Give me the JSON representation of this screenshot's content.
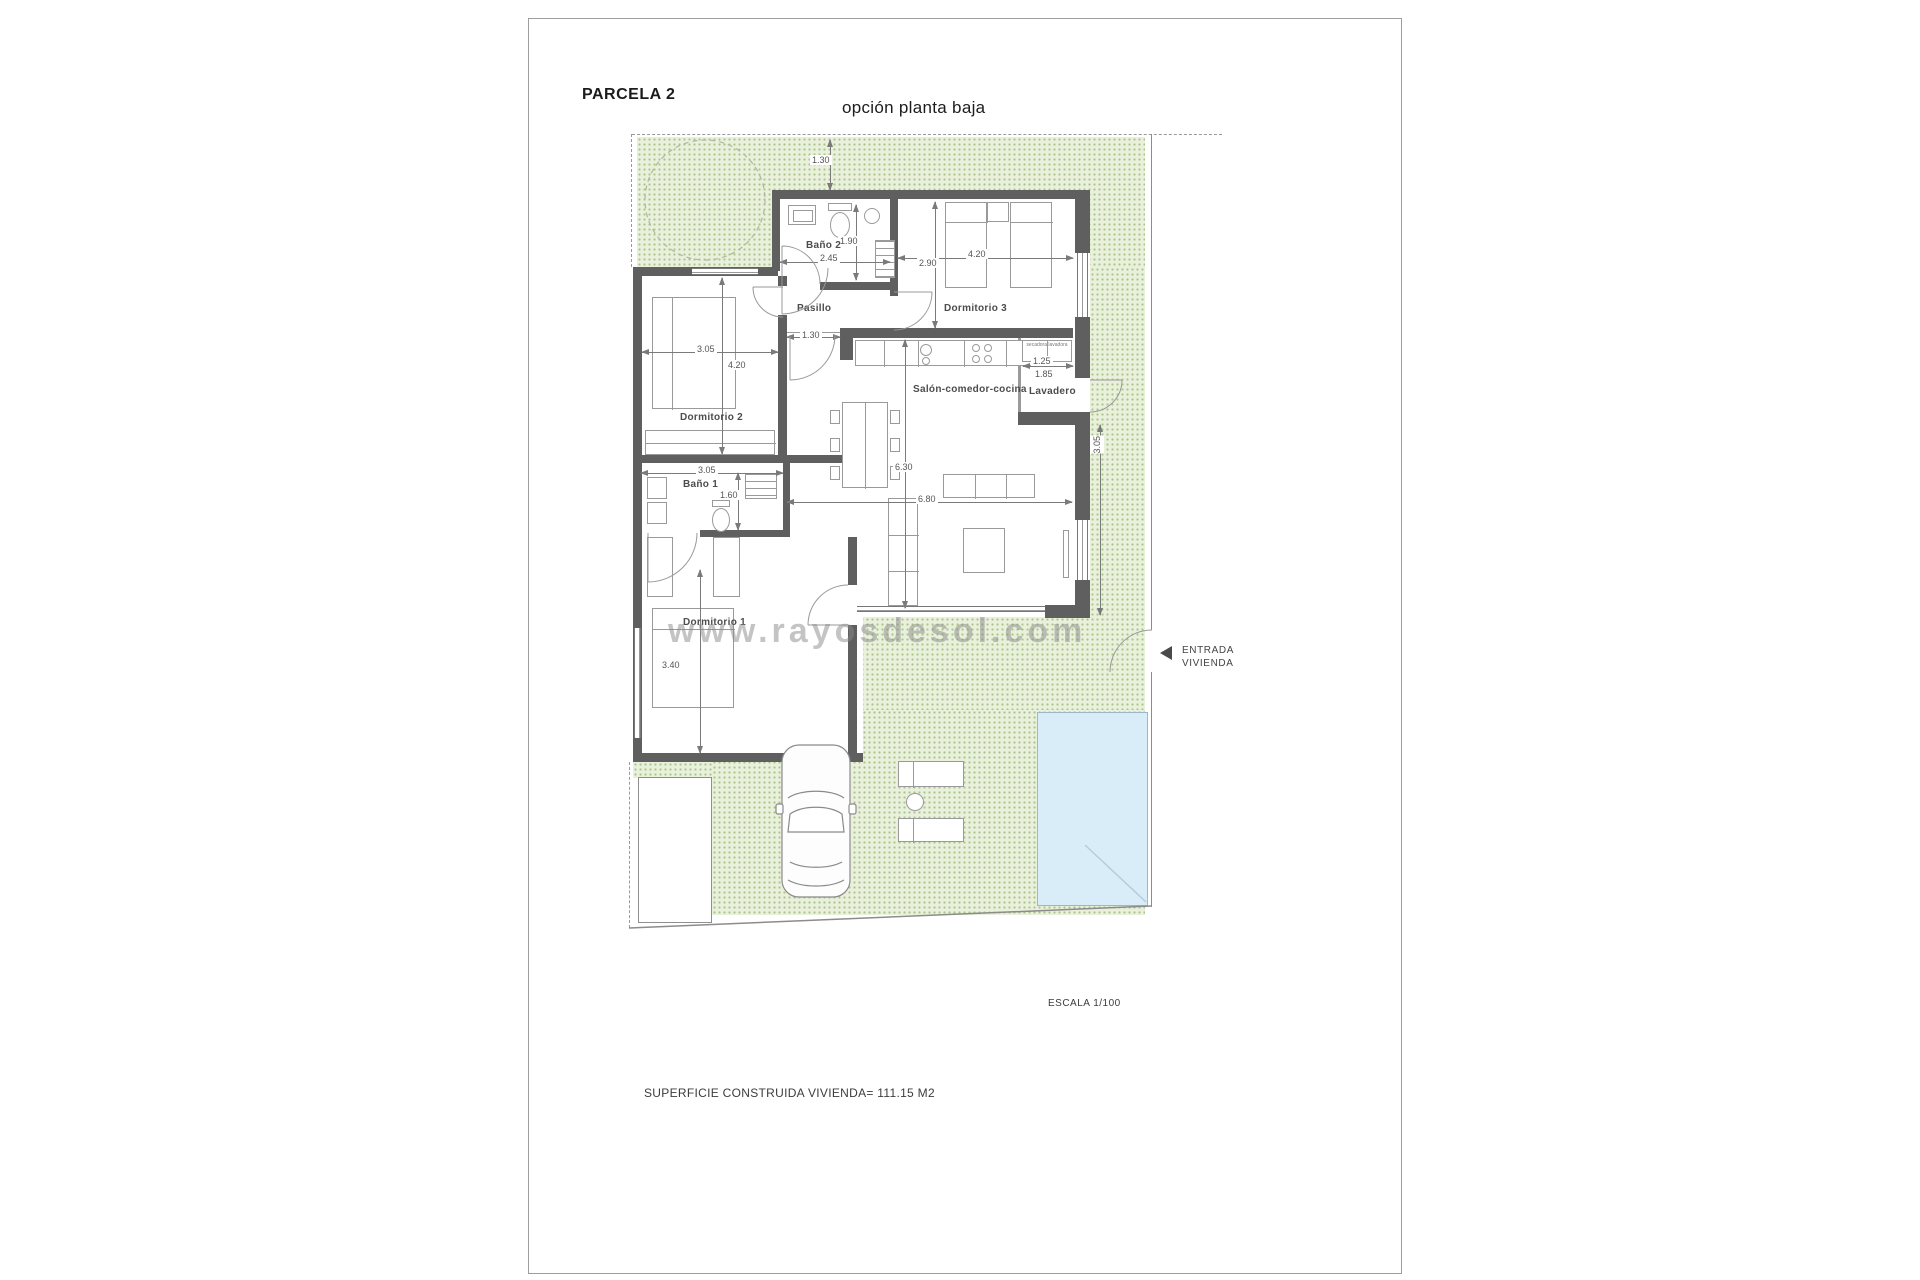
{
  "header": {
    "title": "PARCELA 2",
    "subtitle": "opción planta baja"
  },
  "rooms": {
    "bano2": "Baño 2",
    "pasillo": "Pasillo",
    "dorm3": "Dormitorio 3",
    "dorm2": "Dormitorio 2",
    "salon": "Salón-comedor-cocina",
    "lavadero": "Lavadero",
    "bano1": "Baño 1",
    "dorm1": "Dormitorio 1"
  },
  "dims": {
    "garden": "1.30",
    "bano2_w": "2.45",
    "bano2_h": "1.90",
    "dorm3_w": "4.20",
    "dorm3_h": "2.90",
    "pasillo": "1.30",
    "dorm2_w": "3.05",
    "dorm2_h": "4.20",
    "salon_d": "6.30",
    "salon_w": "6.80",
    "bano1_w": "3.05",
    "bano1_h": "1.60",
    "dorm1_l": "3.40",
    "lav_1": "1.25",
    "lav_2": "1.85",
    "side": "3.05"
  },
  "notes": {
    "laundry": "secadora lavadora",
    "entrance1": "ENTRADA",
    "entrance2": "VIVIENDA",
    "scale": "ESCALA 1/100",
    "area": "SUPERFICIE CONSTRUIDA VIVIENDA= 111.15 M2",
    "watermark": "www.rayosdesol.com"
  },
  "colors": {
    "wall": "#5f5f5f",
    "garden_fill": "#e9f0dc",
    "garden_dot": "#a9c489",
    "pool": "#d9edf8",
    "boundary_line": "#8c8c8c",
    "text": "#3c3c3c"
  }
}
